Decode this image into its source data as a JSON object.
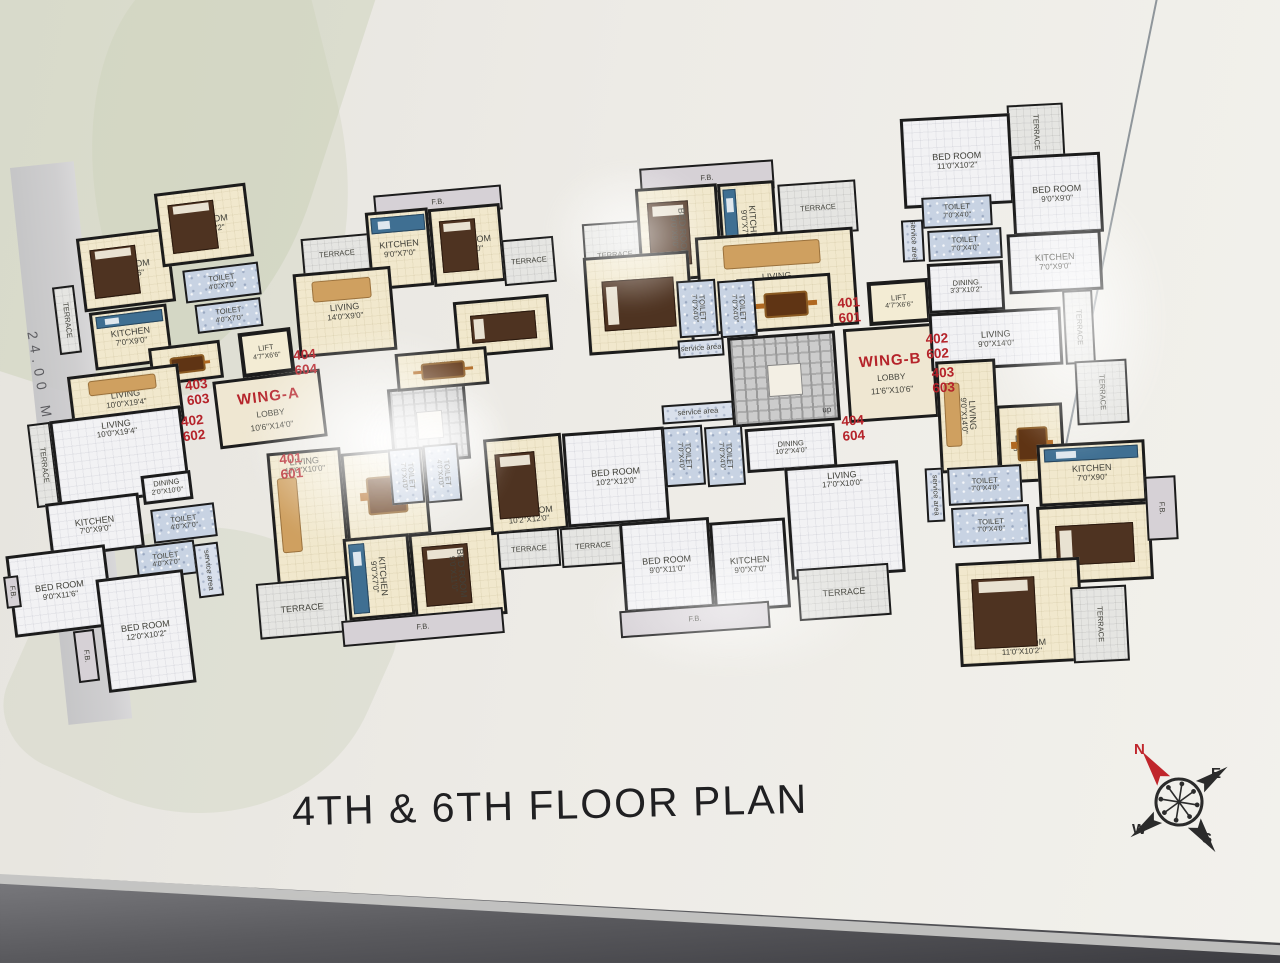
{
  "title": "4TH & 6TH FLOOR PLAN",
  "road_label": "24.00 METER WIDE ROAD",
  "compass": {
    "n": "N",
    "e": "E",
    "w": "W",
    "s": "S"
  },
  "colors": {
    "accent_red": "#b5232a",
    "wall": "#1c1c1c",
    "cream": "#f1e8cd",
    "toilet_blue": "#c8d3e3"
  },
  "unit_tags": [
    {
      "a": "403",
      "b": "603",
      "x": 186,
      "y": 378,
      "g": "a1"
    },
    {
      "a": "402",
      "b": "602",
      "x": 182,
      "y": 414,
      "g": "a1"
    },
    {
      "a": "404",
      "b": "604",
      "x": 294,
      "y": 348,
      "g": "a2"
    },
    {
      "a": "401",
      "b": "601",
      "x": 280,
      "y": 452,
      "g": "a2"
    },
    {
      "a": "401",
      "b": "601",
      "x": 838,
      "y": 296,
      "g": "b1"
    },
    {
      "a": "402",
      "b": "602",
      "x": 926,
      "y": 332,
      "g": "b2"
    },
    {
      "a": "403",
      "b": "603",
      "x": 932,
      "y": 366,
      "g": "b2"
    },
    {
      "a": "404",
      "b": "604",
      "x": 842,
      "y": 414,
      "g": "b1"
    }
  ],
  "rooms": [
    {
      "g": "a1",
      "f": "terrace",
      "n": "TERRACE",
      "x": 56,
      "y": 286,
      "w": 22,
      "h": 68,
      "vert": 1,
      "sm": 1
    },
    {
      "g": "a1",
      "f": "cream",
      "n": "BED ROOM",
      "d": "9'0\"X11'6\"",
      "x": 80,
      "y": 233,
      "w": 92,
      "h": 74,
      "furn": "bed"
    },
    {
      "g": "a1",
      "f": "cream",
      "n": "BED ROOM",
      "d": "12'0\"X10'2\"",
      "x": 158,
      "y": 188,
      "w": 92,
      "h": 74,
      "furn": "bed"
    },
    {
      "g": "a1",
      "f": "toilet",
      "n": "TOILET",
      "d": "4'0\"X7'0\"",
      "x": 184,
      "y": 266,
      "w": 76,
      "h": 33,
      "sm": 1
    },
    {
      "g": "a1",
      "f": "toilet",
      "n": "TOILET",
      "d": "4'0\"X7'0\"",
      "x": 196,
      "y": 301,
      "w": 66,
      "h": 29,
      "sm": 1
    },
    {
      "g": "a1",
      "f": "cream",
      "n": "KITCHEN",
      "d": "7'0\"X9'0\"",
      "x": 92,
      "y": 308,
      "w": 78,
      "h": 58,
      "furn": "counter"
    },
    {
      "g": "a1",
      "f": "cream",
      "n": "DINING",
      "d": "2'0\"X10'2\"",
      "x": 150,
      "y": 344,
      "w": 72,
      "h": 38,
      "furn": "table",
      "sm": 1
    },
    {
      "g": "a1",
      "f": "cream",
      "n": "LIVING",
      "d": "10'0\"X19'4\"",
      "x": 70,
      "y": 370,
      "w": 112,
      "h": 58,
      "furn": "sofa"
    },
    {
      "g": "a1",
      "f": "terrace",
      "n": "TERRACE",
      "x": 32,
      "y": 423,
      "w": 23,
      "h": 84,
      "vert": 1,
      "sm": 1
    },
    {
      "g": "a1",
      "f": "gray",
      "n": "LIVING",
      "d": "10'0\"X19'4\"",
      "x": 54,
      "y": 413,
      "w": 132,
      "h": 87,
      "lp": "t"
    },
    {
      "g": "a1",
      "f": "gray",
      "n": "DINING",
      "d": "2'0\"X10'0\"",
      "x": 142,
      "y": 473,
      "w": 50,
      "h": 29,
      "sm": 1
    },
    {
      "g": "a1",
      "f": "gray",
      "n": "KITCHEN",
      "d": "7'0\"X9'0\"",
      "x": 48,
      "y": 498,
      "w": 94,
      "h": 55
    },
    {
      "g": "a1",
      "f": "toilet",
      "n": "TOILET",
      "d": "4'0\"X7'0\"",
      "x": 152,
      "y": 506,
      "w": 64,
      "h": 34,
      "sm": 1
    },
    {
      "g": "a1",
      "f": "toilet",
      "n": "TOILET",
      "d": "4'0\"X7'0\"",
      "x": 136,
      "y": 543,
      "w": 60,
      "h": 34,
      "sm": 1
    },
    {
      "g": "a1",
      "f": "service",
      "n": "service area",
      "x": 196,
      "y": 543,
      "w": 25,
      "h": 54,
      "vert": 1,
      "sm": 1
    },
    {
      "g": "a1",
      "f": "gray",
      "n": "BED ROOM",
      "d": "9'0\"X11'6\"",
      "x": 10,
      "y": 550,
      "w": 100,
      "h": 82
    },
    {
      "g": "a1",
      "f": "gray",
      "n": "BED ROOM",
      "d": "12'0\"X10'2\"",
      "x": 102,
      "y": 574,
      "w": 88,
      "h": 114
    },
    {
      "g": "a1",
      "f": "fb",
      "n": "F.B.",
      "x": 76,
      "y": 630,
      "w": 21,
      "h": 52,
      "vert": 1,
      "sm": 1
    },
    {
      "g": "a1",
      "f": "fb",
      "n": "F.B.",
      "x": 5,
      "y": 576,
      "w": 15,
      "h": 32,
      "vert": 1,
      "sm": 1
    },
    {
      "g": "a1",
      "f": "lift",
      "n": "LIFT",
      "d": "4'7\"X6'6\"",
      "x": 240,
      "y": 330,
      "w": 53,
      "h": 45,
      "sm": 1
    },
    {
      "g": "a1",
      "f": "lobby",
      "n": "WING-A",
      "lobby": "LOBBY",
      "d": "10'6\"X14'0\"",
      "x": 216,
      "y": 375,
      "w": 108,
      "h": 68,
      "dn": "wing-a-lobby"
    },
    {
      "g": "a2",
      "f": "stair",
      "x": 390,
      "y": 386,
      "w": 78,
      "h": 76,
      "dn": "stairs-wing-a"
    },
    {
      "g": "a2",
      "f": "fb",
      "n": "F.B.",
      "x": 374,
      "y": 190,
      "w": 128,
      "h": 25,
      "sm": 1
    },
    {
      "g": "a2",
      "f": "terrace",
      "n": "TERRACE",
      "x": 302,
      "y": 236,
      "w": 70,
      "h": 37,
      "sm": 1
    },
    {
      "g": "a2",
      "f": "cream",
      "n": "KITCHEN",
      "d": "9'0\"X7'0\"",
      "x": 368,
      "y": 210,
      "w": 63,
      "h": 78,
      "furn": "counter"
    },
    {
      "g": "a2",
      "f": "cream",
      "n": "BED ROOM",
      "d": "9'0\"X9'0\"",
      "x": 431,
      "y": 206,
      "w": 72,
      "h": 78,
      "furn": "bed"
    },
    {
      "g": "a2",
      "f": "terrace",
      "n": "TERRACE",
      "x": 503,
      "y": 238,
      "w": 52,
      "h": 46,
      "sm": 1
    },
    {
      "g": "a2",
      "f": "cream",
      "n": "LIVING",
      "d": "14'0\"X9'0\"",
      "x": 296,
      "y": 270,
      "w": 98,
      "h": 84,
      "furn": "sofa"
    },
    {
      "g": "a2",
      "f": "cream",
      "n": "BED ROOM",
      "d": "10'2\"X11'0\"",
      "x": 455,
      "y": 298,
      "w": 96,
      "h": 56,
      "furn": "bed-h"
    },
    {
      "g": "a2",
      "f": "cream",
      "n": "DINING",
      "d": "10'2\"X4'0\"",
      "x": 396,
      "y": 350,
      "w": 92,
      "h": 38,
      "furn": "table",
      "sm": 1
    },
    {
      "g": "a2",
      "f": "cream",
      "n": "LIVING",
      "d": "17'0\"X10'0\"",
      "x": 272,
      "y": 450,
      "w": 74,
      "h": 132,
      "lp": "t",
      "furn": "sofa-v"
    },
    {
      "g": "a2",
      "f": "cream",
      "n": "DINING",
      "d": "10'2\"X4'0\"",
      "x": 344,
      "y": 450,
      "w": 84,
      "h": 88,
      "furn": "table"
    },
    {
      "g": "a2",
      "f": "toilet",
      "n": "TOILET",
      "d": "7'0\"X4'0\"",
      "x": 390,
      "y": 448,
      "w": 33,
      "h": 56,
      "vert": 1,
      "sm": 1
    },
    {
      "g": "a2",
      "f": "toilet",
      "n": "TOILET",
      "d": "4'0\"X4'0\"",
      "x": 425,
      "y": 444,
      "w": 35,
      "h": 58,
      "vert": 1,
      "sm": 1
    },
    {
      "g": "a2",
      "f": "cream",
      "n": "KITCHEN",
      "d": "9'0\"X7'0\"",
      "x": 346,
      "y": 536,
      "w": 66,
      "h": 82,
      "vert": 1,
      "furn": "counter-v"
    },
    {
      "g": "a2",
      "f": "cream",
      "n": "BED ROOM",
      "d": "9'0\"X11'0\"",
      "x": 412,
      "y": 530,
      "w": 92,
      "h": 88,
      "vert": 1,
      "furn": "bed"
    },
    {
      "g": "a2",
      "f": "terrace",
      "n": "TERRACE",
      "x": 258,
      "y": 580,
      "w": 88,
      "h": 56
    },
    {
      "g": "a2",
      "f": "fb",
      "n": "F.B.",
      "x": 342,
      "y": 614,
      "w": 162,
      "h": 26,
      "sm": 1
    },
    {
      "g": "a2",
      "f": "cream",
      "n": "BED ROOM",
      "d": "10'2\"X12'0\"",
      "x": 487,
      "y": 436,
      "w": 78,
      "h": 96,
      "lp": "b",
      "furn": "bed"
    },
    {
      "g": "b1",
      "f": "gray",
      "n": "BED ROOM",
      "d": "10'2\"X12'0\"",
      "x": 565,
      "y": 430,
      "w": 102,
      "h": 94
    },
    {
      "g": "b1",
      "f": "terrace",
      "n": "TERRACE",
      "x": 498,
      "y": 530,
      "w": 62,
      "h": 38,
      "sm": 1
    },
    {
      "g": "b1",
      "f": "terrace",
      "n": "TERRACE",
      "x": 561,
      "y": 526,
      "w": 64,
      "h": 40,
      "sm": 1
    },
    {
      "g": "b1",
      "f": "fb",
      "n": "F.B.",
      "x": 640,
      "y": 164,
      "w": 134,
      "h": 29,
      "sm": 1
    },
    {
      "g": "b1",
      "f": "terrace",
      "n": "TERRACE",
      "x": 584,
      "y": 222,
      "w": 62,
      "h": 66,
      "sm": 1
    },
    {
      "g": "b1",
      "f": "cream",
      "n": "BED ROOM",
      "d": "9'0\"X9'0\"",
      "x": 638,
      "y": 186,
      "w": 82,
      "h": 94,
      "vert": 1,
      "furn": "bed"
    },
    {
      "g": "b1",
      "f": "cream",
      "n": "KITCHEN",
      "d": "9'0\"X7'0\"",
      "x": 720,
      "y": 182,
      "w": 57,
      "h": 88,
      "vert": 1,
      "furn": "counter-v"
    },
    {
      "g": "b1",
      "f": "terrace",
      "n": "TERRACE",
      "x": 779,
      "y": 182,
      "w": 78,
      "h": 52,
      "sm": 1
    },
    {
      "g": "b1",
      "f": "cream",
      "n": "BED ROOM",
      "d": "10'2\"X11'0\"",
      "x": 586,
      "y": 254,
      "w": 106,
      "h": 98,
      "furn": "bed-h"
    },
    {
      "g": "b1",
      "f": "cream",
      "n": "LIVING",
      "d": "14'0\"X9'0\"",
      "x": 698,
      "y": 232,
      "w": 158,
      "h": 98,
      "furn": "sofa"
    },
    {
      "g": "b1",
      "f": "cream",
      "n": "DINING",
      "d": "10'2\"X3'3\"",
      "x": 738,
      "y": 276,
      "w": 94,
      "h": 54,
      "furn": "table"
    },
    {
      "g": "b1",
      "f": "toilet",
      "n": "TOILET",
      "d": "7'0\"X4'0\"",
      "x": 678,
      "y": 280,
      "w": 39,
      "h": 57,
      "vert": 1,
      "sm": 1
    },
    {
      "g": "b1",
      "f": "toilet",
      "n": "TOILET",
      "d": "7'0\"X4'0\"",
      "x": 719,
      "y": 280,
      "w": 37,
      "h": 57,
      "vert": 1,
      "sm": 1
    },
    {
      "g": "b1",
      "f": "service",
      "n": "service area",
      "x": 678,
      "y": 339,
      "w": 46,
      "h": 18,
      "sm": 1
    },
    {
      "g": "b1",
      "f": "stair",
      "x": 730,
      "y": 334,
      "w": 108,
      "h": 90,
      "up": "up",
      "dn": "stairs-wing-b"
    },
    {
      "g": "b1",
      "f": "service",
      "n": "service area",
      "x": 662,
      "y": 403,
      "w": 72,
      "h": 19,
      "sm": 1
    },
    {
      "g": "b1",
      "f": "lift",
      "n": "LIFT",
      "d": "4'7\"X6'6\"",
      "x": 868,
      "y": 280,
      "w": 62,
      "h": 44,
      "sm": 1
    },
    {
      "g": "b1",
      "f": "lobby",
      "n": "WING-B",
      "lobby": "LOBBY",
      "d": "11'6\"X10'6\"",
      "x": 846,
      "y": 326,
      "w": 90,
      "h": 94,
      "dn": "wing-b-lobby"
    },
    {
      "g": "b1",
      "f": "toilet",
      "n": "TOILET",
      "d": "7'0\"X4'0\"",
      "x": 664,
      "y": 426,
      "w": 40,
      "h": 60,
      "vert": 1,
      "sm": 1
    },
    {
      "g": "b1",
      "f": "toilet",
      "n": "TOILET",
      "d": "7'0\"X4'0\"",
      "x": 706,
      "y": 426,
      "w": 38,
      "h": 60,
      "vert": 1,
      "sm": 1
    },
    {
      "g": "b1",
      "f": "gray",
      "n": "DINING",
      "d": "10'2\"X4'0\"",
      "x": 746,
      "y": 426,
      "w": 90,
      "h": 44,
      "sm": 1
    },
    {
      "g": "b1",
      "f": "gray",
      "n": "BED ROOM",
      "d": "9'0\"X11'0\"",
      "x": 622,
      "y": 520,
      "w": 90,
      "h": 90
    },
    {
      "g": "b1",
      "f": "gray",
      "n": "KITCHEN",
      "d": "9'0\"X7'0\"",
      "x": 712,
      "y": 520,
      "w": 76,
      "h": 90
    },
    {
      "g": "b1",
      "f": "fb",
      "n": "F.B.",
      "x": 620,
      "y": 606,
      "w": 150,
      "h": 27,
      "sm": 1
    },
    {
      "g": "b1",
      "f": "gray",
      "n": "LIVING",
      "d": "17'0\"X10'0\"",
      "x": 788,
      "y": 464,
      "w": 114,
      "h": 112,
      "lp": "t"
    },
    {
      "g": "b1",
      "f": "terrace",
      "n": "TERRACE",
      "x": 798,
      "y": 566,
      "w": 92,
      "h": 52
    },
    {
      "g": "b2",
      "f": "terrace",
      "n": "TERRACE",
      "x": 1008,
      "y": 104,
      "w": 56,
      "h": 56,
      "vert": 1,
      "sm": 1
    },
    {
      "g": "b2",
      "f": "gray",
      "n": "BED ROOM",
      "d": "11'0\"X10'2\"",
      "x": 902,
      "y": 116,
      "w": 110,
      "h": 90
    },
    {
      "g": "b2",
      "f": "gray",
      "n": "BED ROOM",
      "d": "9'0\"X9'0\"",
      "x": 1012,
      "y": 154,
      "w": 90,
      "h": 80
    },
    {
      "g": "b2",
      "f": "toilet",
      "n": "TOILET",
      "d": "7'0\"X4'0\"",
      "x": 922,
      "y": 196,
      "w": 70,
      "h": 31,
      "sm": 1
    },
    {
      "g": "b2",
      "f": "toilet",
      "n": "TOILET",
      "d": "7'0\"X4'0\"",
      "x": 928,
      "y": 229,
      "w": 74,
      "h": 31,
      "sm": 1
    },
    {
      "g": "b2",
      "f": "service",
      "n": "service area",
      "x": 902,
      "y": 220,
      "w": 22,
      "h": 42,
      "vert": 1,
      "sm": 1
    },
    {
      "g": "b2",
      "f": "gray",
      "n": "DINING",
      "d": "3'3\"X10'2\"",
      "x": 928,
      "y": 262,
      "w": 76,
      "h": 50,
      "sm": 1
    },
    {
      "g": "b2",
      "f": "gray",
      "n": "KITCHEN",
      "d": "7'0\"X9'0\"",
      "x": 1008,
      "y": 232,
      "w": 94,
      "h": 60
    },
    {
      "g": "b2",
      "f": "gray",
      "n": "LIVING",
      "d": "9'0\"X14'0\"",
      "x": 930,
      "y": 310,
      "w": 132,
      "h": 58
    },
    {
      "g": "b2",
      "f": "terrace",
      "n": "TERRACE",
      "x": 1064,
      "y": 290,
      "w": 30,
      "h": 74,
      "vert": 1,
      "sm": 1
    },
    {
      "g": "b2",
      "f": "cream",
      "n": "LIVING",
      "d": "9'0\"X14'0\"",
      "x": 938,
      "y": 360,
      "w": 60,
      "h": 112,
      "vert": 1,
      "furn": "sofa-v"
    },
    {
      "g": "b2",
      "f": "cream",
      "n": "DINING",
      "d": "3'3\"X10'2\"",
      "x": 998,
      "y": 404,
      "w": 66,
      "h": 78,
      "furn": "table"
    },
    {
      "g": "b2",
      "f": "toilet",
      "n": "TOILET",
      "d": "7'0\"X4'0\"",
      "x": 948,
      "y": 466,
      "w": 74,
      "h": 38,
      "sm": 1
    },
    {
      "g": "b2",
      "f": "toilet",
      "n": "TOILET",
      "d": "7'0\"X4'0\"",
      "x": 952,
      "y": 506,
      "w": 78,
      "h": 40,
      "sm": 1
    },
    {
      "g": "b2",
      "f": "service",
      "n": "service area",
      "x": 926,
      "y": 468,
      "w": 18,
      "h": 54,
      "vert": 1,
      "sm": 1
    },
    {
      "g": "b2",
      "f": "cream",
      "n": "KITCHEN",
      "d": "7'0\"X90\"",
      "x": 1038,
      "y": 442,
      "w": 108,
      "h": 62,
      "furn": "counter"
    },
    {
      "g": "b2",
      "f": "cream",
      "n": "BED ROOM",
      "d": "9'0\"X9'0\"",
      "x": 1038,
      "y": 504,
      "w": 114,
      "h": 78,
      "furn": "bed-h"
    },
    {
      "g": "b2",
      "f": "terrace",
      "n": "TERRACE",
      "x": 1076,
      "y": 360,
      "w": 52,
      "h": 64,
      "vert": 1,
      "sm": 1
    },
    {
      "g": "b2",
      "f": "fb",
      "n": "F.B.",
      "x": 1146,
      "y": 476,
      "w": 31,
      "h": 64,
      "vert": 1,
      "sm": 1
    },
    {
      "g": "b2",
      "f": "cream",
      "n": "BED ROOM",
      "d": "11'0\"X10'2''",
      "x": 958,
      "y": 560,
      "w": 124,
      "h": 104,
      "lp": "b",
      "furn": "bed"
    },
    {
      "g": "b2",
      "f": "terrace",
      "n": "TERRACE",
      "x": 1072,
      "y": 586,
      "w": 56,
      "h": 76,
      "vert": 1,
      "sm": 1
    }
  ]
}
